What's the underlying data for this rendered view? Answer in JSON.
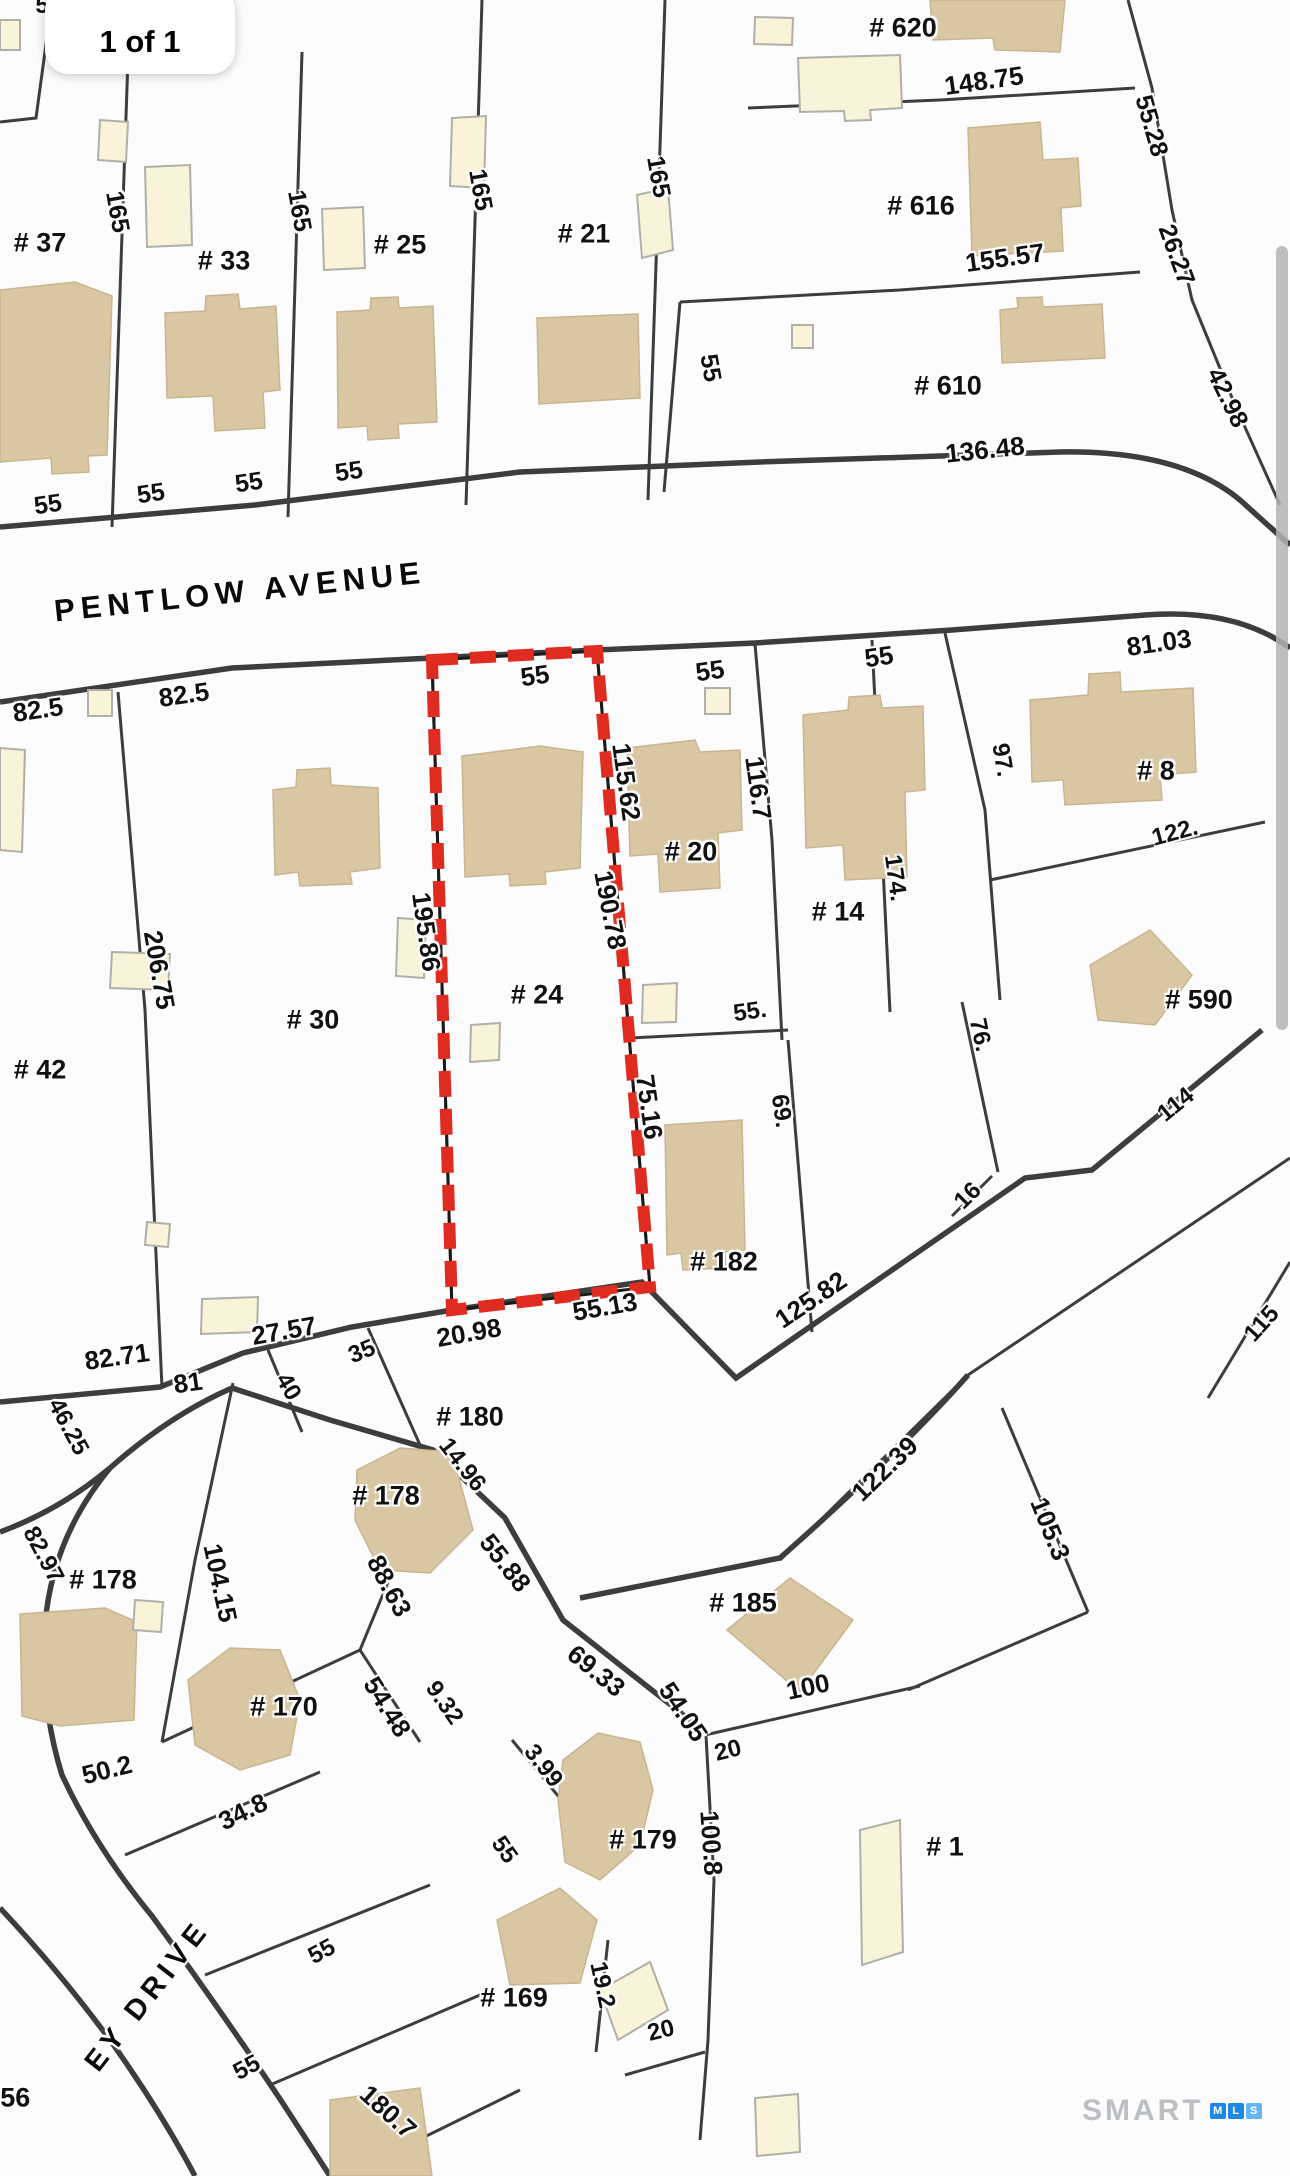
{
  "page": {
    "indicator": "1 of 1"
  },
  "branding": {
    "smart": "SMART",
    "mls_letters": [
      "M",
      "L",
      "S"
    ]
  },
  "colors": {
    "line": "#3d3d3d",
    "highlight_red": "#e02b20",
    "house_tan": "#d9c7a4",
    "shed_yellow": "#f8f3d9",
    "scrollbar_gray": "#b3b3b3"
  },
  "map": {
    "streets": [
      {
        "t": "PENTLOW AVENUE",
        "x": 240,
        "y": 592,
        "r": -6,
        "s": 31
      },
      {
        "t": "EY DRIVE",
        "x": 148,
        "y": 1996,
        "r": -52,
        "s": 29
      }
    ],
    "lot_labels": [
      {
        "t": "# 37",
        "x": 40,
        "y": 243
      },
      {
        "t": "# 33",
        "x": 224,
        "y": 261
      },
      {
        "t": "# 25",
        "x": 400,
        "y": 245
      },
      {
        "t": "# 21",
        "x": 584,
        "y": 234
      },
      {
        "t": "# 620",
        "x": 903,
        "y": 28
      },
      {
        "t": "# 616",
        "x": 921,
        "y": 206
      },
      {
        "t": "# 610",
        "x": 948,
        "y": 386
      },
      {
        "t": "# 42",
        "x": 40,
        "y": 1070
      },
      {
        "t": "# 30",
        "x": 313,
        "y": 1020
      },
      {
        "t": "# 24",
        "x": 537,
        "y": 995
      },
      {
        "t": "# 20",
        "x": 691,
        "y": 852
      },
      {
        "t": "# 14",
        "x": 838,
        "y": 912
      },
      {
        "t": "# 8",
        "x": 1156,
        "y": 771
      },
      {
        "t": "# 590",
        "x": 1199,
        "y": 1000
      },
      {
        "t": "# 182",
        "x": 724,
        "y": 1262
      },
      {
        "t": "# 180",
        "x": 470,
        "y": 1417
      },
      {
        "t": "# 178",
        "x": 103,
        "y": 1580
      },
      {
        "t": "# 178",
        "x": 386,
        "y": 1496
      },
      {
        "t": "# 170",
        "x": 284,
        "y": 1707
      },
      {
        "t": "# 185",
        "x": 743,
        "y": 1603
      },
      {
        "t": "# 179",
        "x": 643,
        "y": 1840
      },
      {
        "t": "# 169",
        "x": 514,
        "y": 1998
      },
      {
        "t": "# 1",
        "x": 945,
        "y": 1847
      },
      {
        "t": "# 56",
        "x": 4,
        "y": 2098
      }
    ],
    "dim_labels": [
      {
        "t": "5",
        "x": 42,
        "y": 6,
        "r": 0,
        "s": 24
      },
      {
        "t": "165",
        "x": 117,
        "y": 212,
        "r": 80,
        "s": 25
      },
      {
        "t": "165",
        "x": 299,
        "y": 211,
        "r": 80,
        "s": 25
      },
      {
        "t": "165",
        "x": 480,
        "y": 190,
        "r": 80,
        "s": 25
      },
      {
        "t": "165",
        "x": 658,
        "y": 177,
        "r": 80,
        "s": 25
      },
      {
        "t": "148.75",
        "x": 984,
        "y": 81,
        "r": -8,
        "s": 26
      },
      {
        "t": "155.57",
        "x": 1005,
        "y": 258,
        "r": -8,
        "s": 26
      },
      {
        "t": "136.48",
        "x": 985,
        "y": 450,
        "r": -6,
        "s": 26
      },
      {
        "t": "55.28",
        "x": 1151,
        "y": 126,
        "r": 74,
        "s": 25
      },
      {
        "t": "26.27",
        "x": 1176,
        "y": 255,
        "r": 70,
        "s": 25
      },
      {
        "t": "42.98",
        "x": 1227,
        "y": 398,
        "r": 64,
        "s": 25
      },
      {
        "t": "55",
        "x": 710,
        "y": 368,
        "r": 80,
        "s": 25
      },
      {
        "t": "55",
        "x": 48,
        "y": 505,
        "r": -8,
        "s": 25
      },
      {
        "t": "55",
        "x": 151,
        "y": 494,
        "r": -8,
        "s": 25
      },
      {
        "t": "55",
        "x": 249,
        "y": 483,
        "r": -8,
        "s": 25
      },
      {
        "t": "55",
        "x": 349,
        "y": 472,
        "r": -8,
        "s": 25
      },
      {
        "t": "82.5",
        "x": 38,
        "y": 710,
        "r": -8,
        "s": 26
      },
      {
        "t": "82.5",
        "x": 184,
        "y": 695,
        "r": -8,
        "s": 26
      },
      {
        "t": "55",
        "x": 535,
        "y": 676,
        "r": -8,
        "s": 26
      },
      {
        "t": "55",
        "x": 710,
        "y": 671,
        "r": -8,
        "s": 26
      },
      {
        "t": "55",
        "x": 879,
        "y": 657,
        "r": -8,
        "s": 26
      },
      {
        "t": "81.03",
        "x": 1159,
        "y": 643,
        "r": -8,
        "s": 26
      },
      {
        "t": "115.62",
        "x": 626,
        "y": 782,
        "r": 82,
        "s": 26
      },
      {
        "t": "116.7",
        "x": 758,
        "y": 788,
        "r": 82,
        "s": 26
      },
      {
        "t": "97.",
        "x": 1002,
        "y": 760,
        "r": 80,
        "s": 24
      },
      {
        "t": "174.",
        "x": 895,
        "y": 878,
        "r": 82,
        "s": 24
      },
      {
        "t": "122.",
        "x": 1175,
        "y": 833,
        "r": -15,
        "s": 24
      },
      {
        "t": "206.75",
        "x": 159,
        "y": 970,
        "r": 80,
        "s": 26
      },
      {
        "t": "195.86",
        "x": 426,
        "y": 932,
        "r": 82,
        "s": 26
      },
      {
        "t": "190.78",
        "x": 610,
        "y": 910,
        "r": 79,
        "s": 26
      },
      {
        "t": "55.",
        "x": 750,
        "y": 1012,
        "r": -8,
        "s": 24
      },
      {
        "t": "69.",
        "x": 781,
        "y": 1111,
        "r": 82,
        "s": 24
      },
      {
        "t": "76.",
        "x": 980,
        "y": 1035,
        "r": 78,
        "s": 24
      },
      {
        "t": "114",
        "x": 1176,
        "y": 1105,
        "r": -39,
        "s": 24
      },
      {
        "t": "115",
        "x": 1262,
        "y": 1324,
        "r": -48,
        "s": 24
      },
      {
        "t": "16",
        "x": 968,
        "y": 1196,
        "r": -45,
        "s": 24
      },
      {
        "t": "75.16",
        "x": 649,
        "y": 1107,
        "r": 82,
        "s": 26
      },
      {
        "t": "125.82",
        "x": 811,
        "y": 1300,
        "r": -34,
        "s": 26
      },
      {
        "t": "82.71",
        "x": 117,
        "y": 1357,
        "r": -8,
        "s": 26
      },
      {
        "t": "81",
        "x": 188,
        "y": 1383,
        "r": -8,
        "s": 26
      },
      {
        "t": "27.57",
        "x": 284,
        "y": 1331,
        "r": -10,
        "s": 26
      },
      {
        "t": "40",
        "x": 288,
        "y": 1387,
        "r": 60,
        "s": 24
      },
      {
        "t": "35",
        "x": 362,
        "y": 1352,
        "r": -22,
        "s": 24
      },
      {
        "t": "20.98",
        "x": 469,
        "y": 1333,
        "r": -10,
        "s": 26
      },
      {
        "t": "55.13",
        "x": 605,
        "y": 1307,
        "r": -10,
        "s": 26
      },
      {
        "t": "14.96",
        "x": 462,
        "y": 1465,
        "r": 52,
        "s": 24
      },
      {
        "t": "104.15",
        "x": 220,
        "y": 1583,
        "r": 78,
        "s": 26
      },
      {
        "t": "88.63",
        "x": 389,
        "y": 1586,
        "r": 62,
        "s": 26
      },
      {
        "t": "9.32",
        "x": 444,
        "y": 1703,
        "r": 55,
        "s": 24
      },
      {
        "t": "54.48",
        "x": 387,
        "y": 1707,
        "r": 58,
        "s": 26
      },
      {
        "t": "55.88",
        "x": 505,
        "y": 1563,
        "r": 52,
        "s": 26
      },
      {
        "t": "50.2",
        "x": 107,
        "y": 1770,
        "r": -14,
        "s": 26
      },
      {
        "t": "34.8",
        "x": 243,
        "y": 1812,
        "r": -26,
        "s": 26
      },
      {
        "t": "46.25",
        "x": 68,
        "y": 1427,
        "r": 62,
        "s": 24
      },
      {
        "t": "82.97",
        "x": 43,
        "y": 1555,
        "r": 62,
        "s": 24
      },
      {
        "t": "122.39",
        "x": 885,
        "y": 1469,
        "r": -44,
        "s": 26
      },
      {
        "t": "105.3",
        "x": 1050,
        "y": 1529,
        "r": 68,
        "s": 26
      },
      {
        "t": "100",
        "x": 808,
        "y": 1687,
        "r": -12,
        "s": 26
      },
      {
        "t": "69.33",
        "x": 596,
        "y": 1671,
        "r": 39,
        "s": 26
      },
      {
        "t": "54.05",
        "x": 683,
        "y": 1712,
        "r": 56,
        "s": 26
      },
      {
        "t": "20",
        "x": 728,
        "y": 1751,
        "r": -14,
        "s": 24
      },
      {
        "t": "3.99",
        "x": 543,
        "y": 1766,
        "r": 52,
        "s": 24
      },
      {
        "t": "100.8",
        "x": 711,
        "y": 1843,
        "r": 86,
        "s": 26
      },
      {
        "t": "55",
        "x": 504,
        "y": 1850,
        "r": 55,
        "s": 24
      },
      {
        "t": "19.2",
        "x": 602,
        "y": 1985,
        "r": 78,
        "s": 24
      },
      {
        "t": "20",
        "x": 661,
        "y": 2031,
        "r": -14,
        "s": 24
      },
      {
        "t": "55",
        "x": 322,
        "y": 1952,
        "r": -28,
        "s": 24
      },
      {
        "t": "55",
        "x": 247,
        "y": 2068,
        "r": -28,
        "s": 24
      },
      {
        "t": "180.7",
        "x": 388,
        "y": 2112,
        "r": 42,
        "s": 26
      }
    ]
  }
}
